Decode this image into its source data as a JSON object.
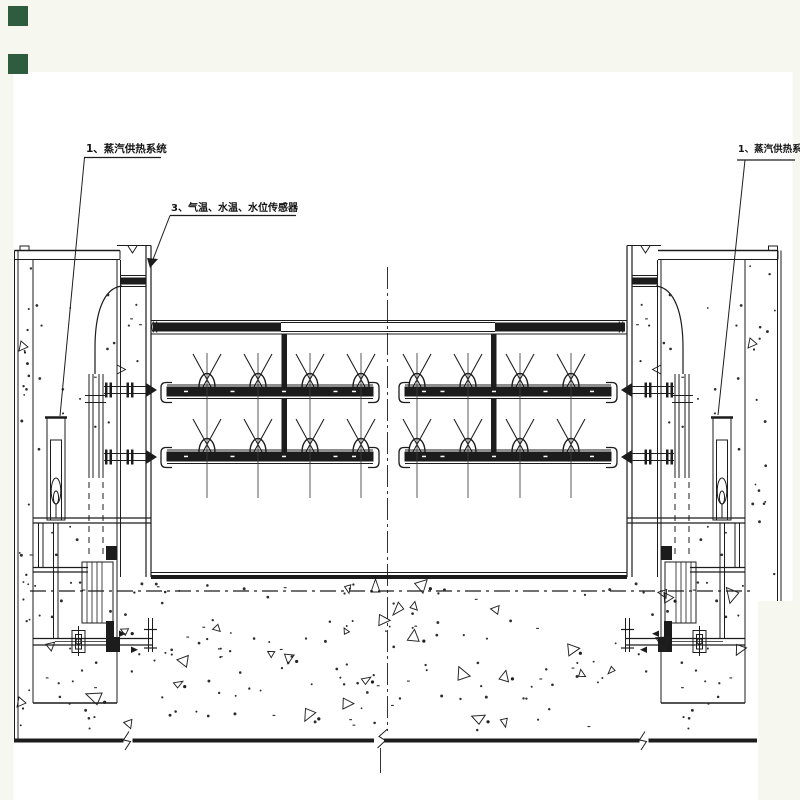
{
  "window": {
    "background_color": "#f6f8f0",
    "paper_color": "#ffffff",
    "ink_color": "#1c1c1c"
  },
  "corner_markers": {
    "color": "#2d5c3e",
    "count": 2
  },
  "labels": {
    "steam_left": "1、蒸汽供热系统",
    "sensors": "3、气温、水温、水位传感器",
    "steam_right": "1、蒸汽供热系统"
  },
  "figure": {
    "type": "engineering-elevation-drawing",
    "nozzle_rows": 2,
    "nozzle_groups_per_row": 2,
    "nozzles_per_group": 4
  }
}
